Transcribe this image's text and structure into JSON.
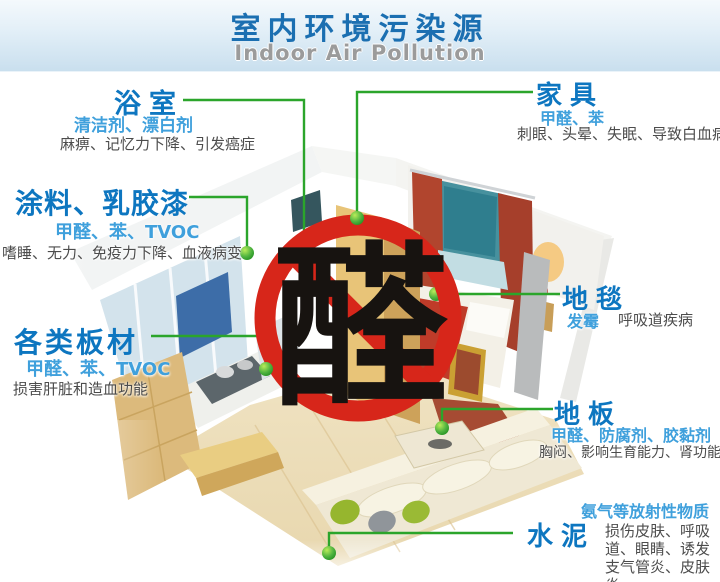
{
  "header": {
    "title": "室内环境污染源",
    "subtitle": "Indoor Air Pollution"
  },
  "sign": {
    "character": "醛",
    "meaning": "no-aldehyde prohibition sign"
  },
  "callouts": [
    {
      "id": "bathroom",
      "title": "浴室",
      "pollutants": "清洁剂、漂白剂",
      "effects": "麻痹、记忆力下降、引发癌症"
    },
    {
      "id": "paint",
      "title": "涂料、乳胶漆",
      "pollutants": "甲醛、苯、TVOC",
      "effects": "嗜睡、无力、免疫力下降、血液病变"
    },
    {
      "id": "boards",
      "title": "各类板材",
      "pollutants": "甲醛、苯、TVOC",
      "effects": "损害肝脏和造血功能"
    },
    {
      "id": "furniture",
      "title": "家具",
      "pollutants": "甲醛、苯",
      "effects": "刺眼、头晕、失眠、导致白血病"
    },
    {
      "id": "carpet",
      "title": "地毯",
      "pollutants": "发霉",
      "effects": "呼吸道疾病"
    },
    {
      "id": "floor",
      "title": "地板",
      "pollutants": "甲醛、防腐剂、胶黏剂",
      "effects": "胸闷、影响生育能力、肾功能"
    },
    {
      "id": "cement",
      "title": "水泥",
      "pollutants": "氨气等放射性物质",
      "effects": "损伤皮肤、呼吸道、眼睛、诱发支气管炎、皮肤炎"
    }
  ],
  "colors": {
    "header_title_blue": "#1b6fb1",
    "header_subtitle_gray": "#9b9b9b",
    "callout_title_blue": "#0d76c0",
    "pollutant_blue": "#3fa0dc",
    "effect_gray": "#4c4c4c",
    "connector_green": "#2ba52b",
    "sign_red": "#d7261a"
  }
}
